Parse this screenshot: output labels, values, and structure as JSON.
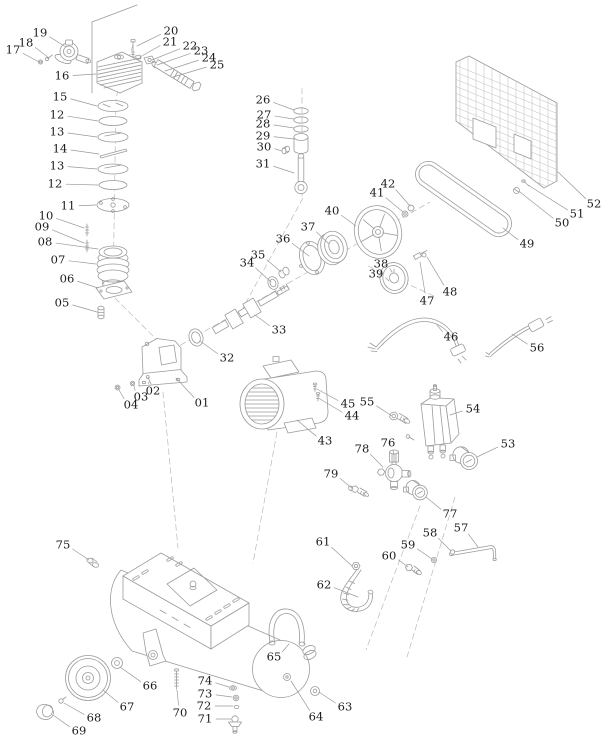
{
  "diagram": {
    "name": "air-compressor-exploded-parts-diagram",
    "canvas": {
      "width": 615,
      "height": 755
    },
    "style": {
      "background": "#ffffff",
      "line_color": "#9b9b9b",
      "label_color": "#1c1c1c"
    },
    "labels": [
      {
        "n": "19",
        "x": 40,
        "y": 33,
        "tx": 66,
        "ty": 47
      },
      {
        "n": "18",
        "x": 26,
        "y": 43,
        "tx": 49,
        "ty": 58
      },
      {
        "n": "17",
        "x": 13,
        "y": 50,
        "tx": 39,
        "ty": 62
      },
      {
        "n": "16",
        "x": 62,
        "y": 76,
        "tx": 96,
        "ty": 74
      },
      {
        "n": "15",
        "x": 60,
        "y": 97,
        "tx": 97,
        "ty": 106
      },
      {
        "n": "12",
        "x": 57,
        "y": 115,
        "tx": 98,
        "ty": 121
      },
      {
        "n": "13",
        "x": 57,
        "y": 132,
        "tx": 97,
        "ty": 137
      },
      {
        "n": "14",
        "x": 60,
        "y": 149,
        "tx": 99,
        "ty": 154
      },
      {
        "n": "13",
        "x": 57,
        "y": 166,
        "tx": 97,
        "ty": 169
      },
      {
        "n": "12",
        "x": 55,
        "y": 184,
        "tx": 98,
        "ty": 185
      },
      {
        "n": "11",
        "x": 68,
        "y": 206,
        "tx": 96,
        "ty": 205
      },
      {
        "n": "10",
        "x": 46,
        "y": 216,
        "tx": 84,
        "ty": 228
      },
      {
        "n": "09",
        "x": 42,
        "y": 227,
        "tx": 84,
        "ty": 243
      },
      {
        "n": "08",
        "x": 45,
        "y": 242,
        "tx": 98,
        "ty": 249
      },
      {
        "n": "07",
        "x": 58,
        "y": 260,
        "tx": 96,
        "ty": 264
      },
      {
        "n": "06",
        "x": 67,
        "y": 279,
        "tx": 98,
        "ty": 288
      },
      {
        "n": "05",
        "x": 62,
        "y": 303,
        "tx": 97,
        "ty": 312
      },
      {
        "n": "20",
        "x": 171,
        "y": 31,
        "tx": 137,
        "ty": 46
      },
      {
        "n": "21",
        "x": 170,
        "y": 42,
        "tx": 140,
        "ty": 57
      },
      {
        "n": "22",
        "x": 190,
        "y": 46,
        "tx": 152,
        "ty": 60
      },
      {
        "n": "23",
        "x": 201,
        "y": 51,
        "tx": 157,
        "ty": 65
      },
      {
        "n": "24",
        "x": 209,
        "y": 58,
        "tx": 165,
        "ty": 71
      },
      {
        "n": "25",
        "x": 217,
        "y": 65,
        "tx": 173,
        "ty": 77
      },
      {
        "n": "26",
        "x": 263,
        "y": 100,
        "tx": 294,
        "ty": 110
      },
      {
        "n": "27",
        "x": 264,
        "y": 115,
        "tx": 294,
        "ty": 119
      },
      {
        "n": "28",
        "x": 263,
        "y": 124,
        "tx": 294,
        "ty": 128
      },
      {
        "n": "29",
        "x": 263,
        "y": 136,
        "tx": 294,
        "ty": 139
      },
      {
        "n": "30",
        "x": 264,
        "y": 147,
        "tx": 282,
        "ty": 151
      },
      {
        "n": "31",
        "x": 263,
        "y": 164,
        "tx": 294,
        "ty": 173
      },
      {
        "n": "40",
        "x": 332,
        "y": 211,
        "tx": 356,
        "ty": 226
      },
      {
        "n": "41",
        "x": 377,
        "y": 193,
        "tx": 403,
        "ty": 212
      },
      {
        "n": "42",
        "x": 388,
        "y": 184,
        "tx": 410,
        "ty": 206
      },
      {
        "n": "37",
        "x": 308,
        "y": 227,
        "tx": 329,
        "ty": 244
      },
      {
        "n": "36",
        "x": 283,
        "y": 239,
        "tx": 309,
        "ty": 256
      },
      {
        "n": "35",
        "x": 258,
        "y": 255,
        "tx": 281,
        "ty": 272
      },
      {
        "n": "34",
        "x": 247,
        "y": 263,
        "tx": 271,
        "ty": 282
      },
      {
        "n": "33",
        "x": 279,
        "y": 330,
        "tx": 255,
        "ty": 315
      },
      {
        "n": "32",
        "x": 227,
        "y": 358,
        "tx": 200,
        "ty": 341
      },
      {
        "n": "38",
        "x": 381,
        "y": 264,
        "tx": 392,
        "ty": 272
      },
      {
        "n": "39",
        "x": 376,
        "y": 274,
        "tx": 389,
        "ty": 281
      },
      {
        "n": "47",
        "x": 427,
        "y": 301,
        "tx": 420,
        "ty": 262
      },
      {
        "n": "48",
        "x": 450,
        "y": 292,
        "tx": 427,
        "ty": 257
      },
      {
        "n": "46",
        "x": 451,
        "y": 337,
        "tx": 437,
        "ty": 325
      },
      {
        "n": "56",
        "x": 537,
        "y": 348,
        "tx": 512,
        "ty": 334
      },
      {
        "n": "49",
        "x": 527,
        "y": 244,
        "tx": 503,
        "ty": 228
      },
      {
        "n": "50",
        "x": 562,
        "y": 223,
        "tx": 520,
        "ty": 192
      },
      {
        "n": "51",
        "x": 577,
        "y": 214,
        "tx": 528,
        "ty": 185
      },
      {
        "n": "52",
        "x": 594,
        "y": 204,
        "tx": 558,
        "ty": 172
      },
      {
        "n": "01",
        "x": 202,
        "y": 403,
        "tx": 176,
        "ty": 378
      },
      {
        "n": "02",
        "x": 153,
        "y": 391,
        "tx": 149,
        "ty": 382
      },
      {
        "n": "03",
        "x": 141,
        "y": 397,
        "tx": 134,
        "ty": 386
      },
      {
        "n": "04",
        "x": 131,
        "y": 405,
        "tx": 119,
        "ty": 390
      },
      {
        "n": "43",
        "x": 325,
        "y": 441,
        "tx": 297,
        "ty": 420
      },
      {
        "n": "44",
        "x": 352,
        "y": 416,
        "tx": 320,
        "ty": 399
      },
      {
        "n": "45",
        "x": 348,
        "y": 404,
        "tx": 317,
        "ty": 389
      },
      {
        "n": "55",
        "x": 367,
        "y": 402,
        "tx": 392,
        "ty": 416
      },
      {
        "n": "54",
        "x": 473,
        "y": 409,
        "tx": 450,
        "ty": 415
      },
      {
        "n": "76",
        "x": 388,
        "y": 443,
        "tx": 394,
        "ty": 455
      },
      {
        "n": "78",
        "x": 362,
        "y": 449,
        "tx": 383,
        "ty": 467
      },
      {
        "n": "53",
        "x": 508,
        "y": 444,
        "tx": 477,
        "ty": 457
      },
      {
        "n": "79",
        "x": 331,
        "y": 474,
        "tx": 353,
        "ty": 489
      },
      {
        "n": "77",
        "x": 450,
        "y": 514,
        "tx": 426,
        "ty": 497
      },
      {
        "n": "57",
        "x": 461,
        "y": 528,
        "tx": 478,
        "ty": 547
      },
      {
        "n": "58",
        "x": 430,
        "y": 533,
        "tx": 451,
        "ty": 551
      },
      {
        "n": "59",
        "x": 408,
        "y": 545,
        "tx": 432,
        "ty": 559
      },
      {
        "n": "60",
        "x": 389,
        "y": 556,
        "tx": 408,
        "ty": 567
      },
      {
        "n": "61",
        "x": 323,
        "y": 542,
        "tx": 352,
        "ty": 566
      },
      {
        "n": "62",
        "x": 324,
        "y": 585,
        "tx": 358,
        "ty": 597
      },
      {
        "n": "75",
        "x": 63,
        "y": 545,
        "tx": 89,
        "ty": 560
      },
      {
        "n": "65",
        "x": 274,
        "y": 657,
        "tx": 289,
        "ty": 644
      },
      {
        "n": "63",
        "x": 345,
        "y": 707,
        "tx": 319,
        "ty": 692
      },
      {
        "n": "64",
        "x": 316,
        "y": 717,
        "tx": 291,
        "ty": 681
      },
      {
        "n": "66",
        "x": 150,
        "y": 686,
        "tx": 120,
        "ty": 667
      },
      {
        "n": "67",
        "x": 127,
        "y": 707,
        "tx": 103,
        "ty": 690
      },
      {
        "n": "68",
        "x": 94,
        "y": 718,
        "tx": 64,
        "ty": 703
      },
      {
        "n": "69",
        "x": 79,
        "y": 731,
        "tx": 53,
        "ty": 715
      },
      {
        "n": "70",
        "x": 180,
        "y": 713,
        "tx": 177,
        "ty": 690
      },
      {
        "n": "74",
        "x": 205,
        "y": 681,
        "tx": 229,
        "ty": 687
      },
      {
        "n": "73",
        "x": 205,
        "y": 694,
        "tx": 232,
        "ty": 697
      },
      {
        "n": "72",
        "x": 204,
        "y": 706,
        "tx": 233,
        "ty": 706
      },
      {
        "n": "71",
        "x": 205,
        "y": 719,
        "tx": 231,
        "ty": 719
      }
    ]
  }
}
